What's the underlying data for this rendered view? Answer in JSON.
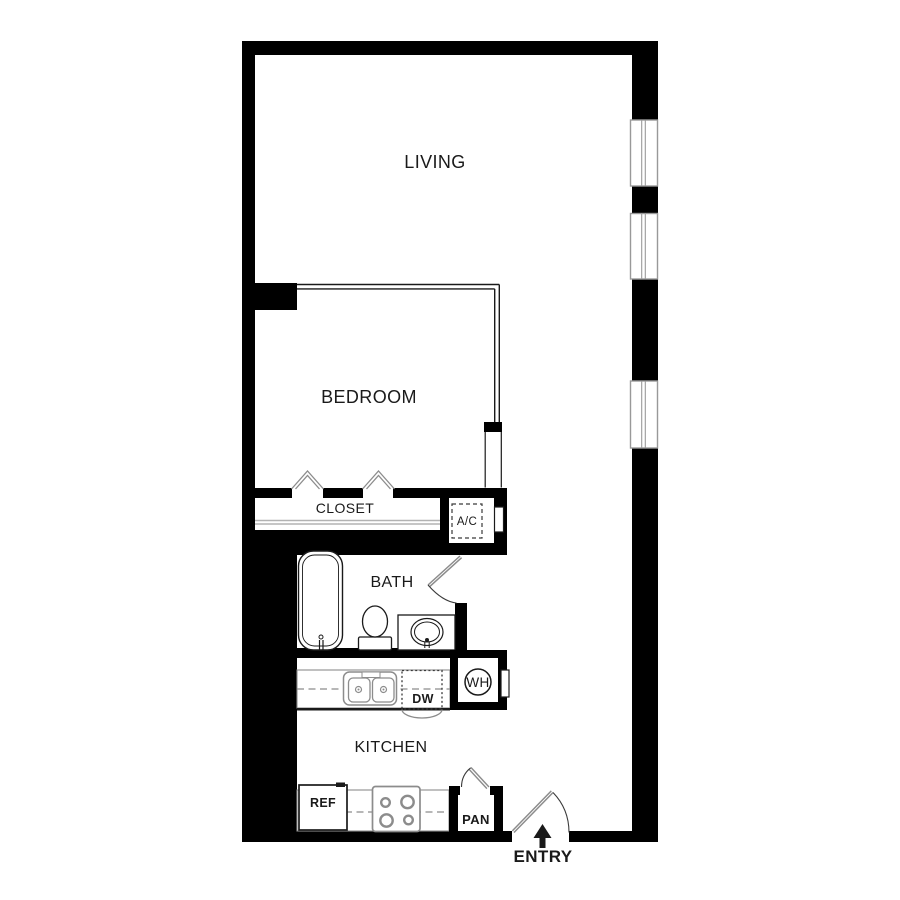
{
  "colors": {
    "wall": "#000000",
    "floor": "#ffffff",
    "ink": "#1a1a1a",
    "steel": "#8c8c8c",
    "frame": "#999999",
    "rod": "#b3b3b3",
    "dash": "#3a3a3a"
  },
  "rooms": {
    "living": "LIVING",
    "bedroom": "BEDROOM",
    "closet": "CLOSET",
    "bath": "BATH",
    "kitchen": "KITCHEN"
  },
  "fixtures": {
    "ac": "A/C",
    "wh": "WH",
    "dw": "DW",
    "ref": "REF",
    "pan": "PAN"
  },
  "entry": {
    "label": "ENTRY"
  }
}
